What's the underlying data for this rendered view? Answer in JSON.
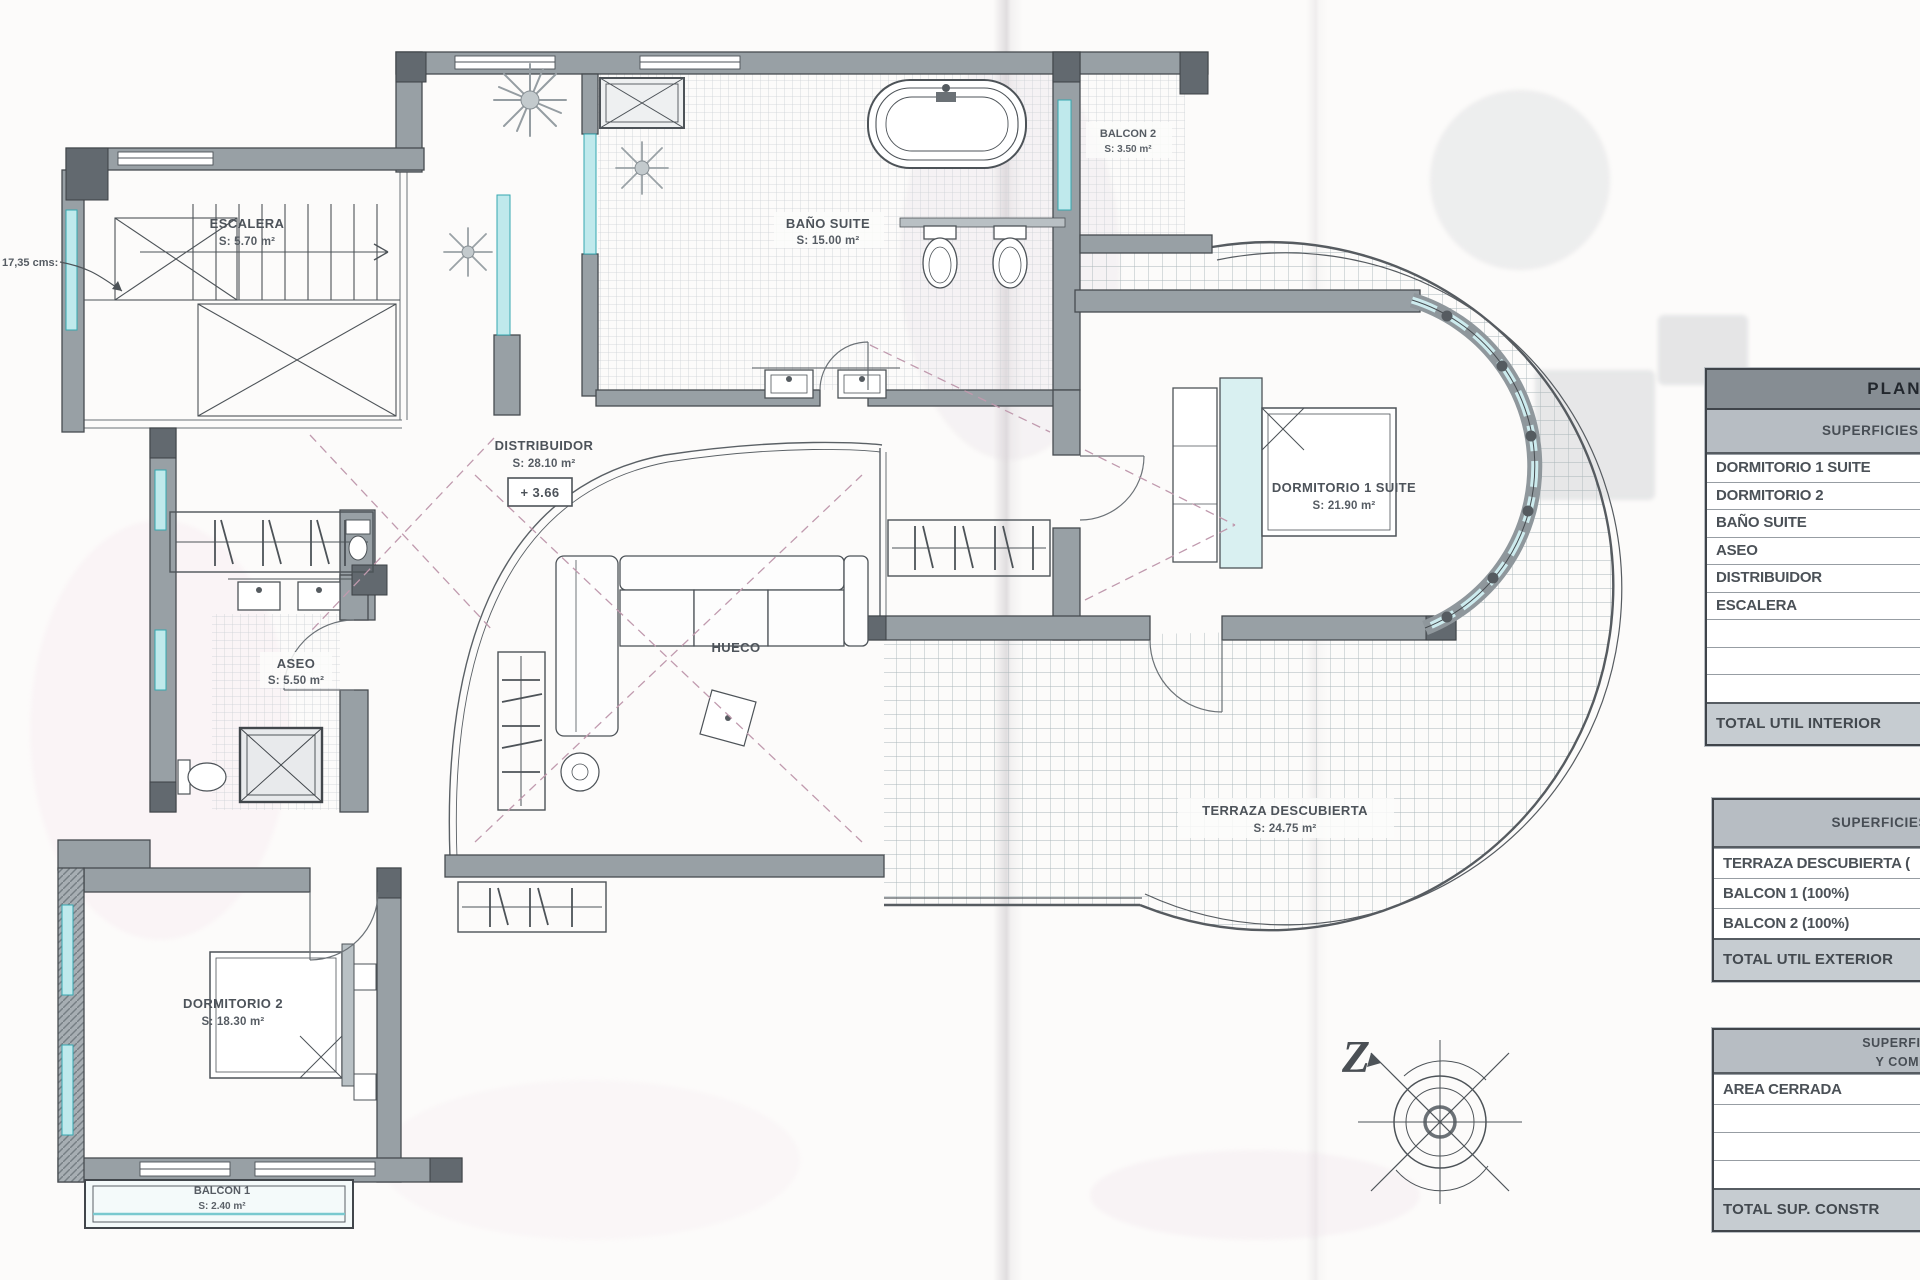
{
  "plan": {
    "annotation_dim": "17,35 cms:",
    "level_marker": "+ 3.66",
    "compass_letter": "Z",
    "rooms": {
      "escalera": {
        "name": "ESCALERA",
        "area": "S: 5.70 m²"
      },
      "distribuidor": {
        "name": "DISTRIBUIDOR",
        "area": "S: 28.10 m²"
      },
      "bano_suite": {
        "name": "BAÑO SUITE",
        "area": "S: 15.00 m²"
      },
      "balcon2": {
        "name": "BALCON 2",
        "area": "S: 3.50 m²"
      },
      "dormitorio1": {
        "name": "DORMITORIO 1 SUITE",
        "area": "S: 21.90 m²"
      },
      "aseo": {
        "name": "ASEO",
        "area": "S: 5.50 m²"
      },
      "hueco": {
        "name": "HUECO"
      },
      "terraza": {
        "name": "TERRAZA DESCUBIERTA",
        "area": "S: 24.75 m²"
      },
      "dormitorio2": {
        "name": "DORMITORIO 2",
        "area": "S: 18.30 m²"
      },
      "balcon1": {
        "name": "BALCON 1",
        "area": "S: 2.40 m²"
      }
    }
  },
  "tables": {
    "interior": {
      "title": "PLANTA A",
      "subtitle": "SUPERFICIES ÚTILES INTE",
      "rows": [
        "DORMITORIO 1 SUITE",
        "DORMITORIO 2",
        "BAÑO SUITE",
        "ASEO",
        "DISTRIBUIDOR",
        "ESCALERA",
        "",
        "",
        ""
      ],
      "total": "TOTAL UTIL INTERIOR"
    },
    "exterior": {
      "subtitle": "SUPERFICIES ÚTILES EXT",
      "rows": [
        "TERRAZA DESCUBIERTA (",
        "BALCON 1 (100%)",
        "BALCON 2 (100%)"
      ],
      "total": "TOTAL UTIL EXTERIOR"
    },
    "construida": {
      "subtitle_line1": "SUPERFICIES CON",
      "subtitle_line2": "Y COMPUTABL",
      "rows": [
        "AREA CERRADA",
        "",
        "",
        ""
      ],
      "total": "TOTAL SUP. CONSTR"
    }
  },
  "colors": {
    "wall": "#98a0a5",
    "wall_dark": "#646b71",
    "line": "#4d5358",
    "window_teal": "#bfe9ec",
    "window_teal_stroke": "#35a7b0",
    "tile": "#ccd1d5",
    "terrace_tile": "#aeb9bc",
    "dash_pink": "#c09aae",
    "paper": "#fcfbfa"
  }
}
